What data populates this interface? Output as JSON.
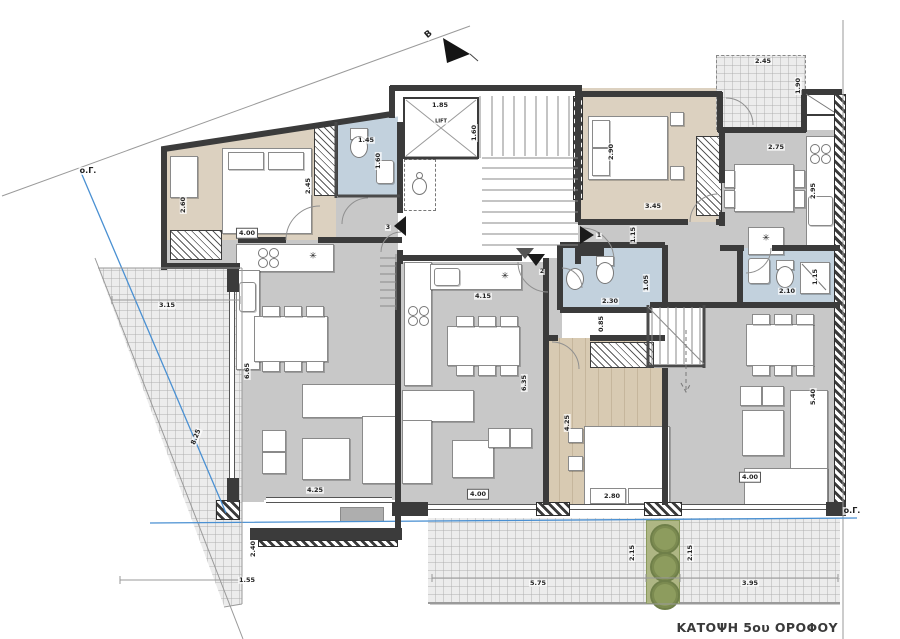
{
  "title": "ΚΑΤΟΨΗ 5ου ΟΡΟΦΟΥ",
  "colors": {
    "wall": "#3b3b3b",
    "floor_gray": "#c8c8c8",
    "floor_beige": "#dcd1c0",
    "floor_wood": "#d8cab2",
    "bath_blue": "#c2d1dd",
    "terrace": "#ececec",
    "planter_green": "#8d9c5e",
    "setback_blue": "#4a90d2"
  },
  "labels": [
    {
      "t": "ο.Γ.",
      "x": 88,
      "y": 171,
      "s": 8,
      "n": "boundary-label"
    },
    {
      "t": "ο.Γ.",
      "x": 852,
      "y": 511,
      "s": 8,
      "n": "boundary-label"
    },
    {
      "t": "B",
      "x": 429,
      "y": 35,
      "r": -40,
      "s": 9,
      "n": "north-label"
    },
    {
      "t": "1.85",
      "x": 440,
      "y": 105
    },
    {
      "t": "LIFT",
      "x": 441,
      "y": 122,
      "s": 5,
      "n": "lift-label"
    },
    {
      "t": "1.60",
      "x": 474,
      "y": 133,
      "r": -90
    },
    {
      "t": "1.45",
      "x": 366,
      "y": 140
    },
    {
      "t": "1.60",
      "x": 378,
      "y": 161,
      "r": -90
    },
    {
      "t": "2.45",
      "x": 308,
      "y": 186,
      "r": -90
    },
    {
      "t": "2.60",
      "x": 183,
      "y": 205,
      "r": -90
    },
    {
      "t": "4.00",
      "x": 247,
      "y": 233,
      "box": true
    },
    {
      "t": "3.15",
      "x": 167,
      "y": 305
    },
    {
      "t": "8.25",
      "x": 196,
      "y": 437,
      "r": -68
    },
    {
      "t": "6.65",
      "x": 247,
      "y": 371,
      "r": -90
    },
    {
      "t": "4.25",
      "x": 315,
      "y": 490
    },
    {
      "t": "2.40",
      "x": 253,
      "y": 549,
      "r": -90
    },
    {
      "t": "1.55",
      "x": 247,
      "y": 580
    },
    {
      "t": "4.15",
      "x": 483,
      "y": 296
    },
    {
      "t": "6.35",
      "x": 524,
      "y": 383,
      "r": -90
    },
    {
      "t": "4.00",
      "x": 478,
      "y": 494,
      "box": true
    },
    {
      "t": "4.25",
      "x": 567,
      "y": 423,
      "r": -90
    },
    {
      "t": "2.80",
      "x": 612,
      "y": 496
    },
    {
      "t": "2.30",
      "x": 610,
      "y": 301
    },
    {
      "t": "1.05",
      "x": 646,
      "y": 283,
      "r": -90
    },
    {
      "t": "0.85",
      "x": 601,
      "y": 324,
      "r": -90
    },
    {
      "t": "2.90",
      "x": 611,
      "y": 152,
      "r": -90
    },
    {
      "t": "3.45",
      "x": 653,
      "y": 206
    },
    {
      "t": "1.15",
      "x": 633,
      "y": 235,
      "r": -90
    },
    {
      "t": "2.45",
      "x": 763,
      "y": 61
    },
    {
      "t": "1.90",
      "x": 798,
      "y": 86,
      "r": -90
    },
    {
      "t": "2.75",
      "x": 776,
      "y": 147
    },
    {
      "t": "2.95",
      "x": 813,
      "y": 191,
      "r": -90
    },
    {
      "t": "2.10",
      "x": 787,
      "y": 291
    },
    {
      "t": "1.15",
      "x": 815,
      "y": 277,
      "r": -90
    },
    {
      "t": "5.40",
      "x": 813,
      "y": 397,
      "r": -90
    },
    {
      "t": "4.00",
      "x": 750,
      "y": 477,
      "box": true
    },
    {
      "t": "2.15",
      "x": 632,
      "y": 553,
      "r": -90
    },
    {
      "t": "2.15",
      "x": 690,
      "y": 553,
      "r": -90
    },
    {
      "t": "5.75",
      "x": 538,
      "y": 583
    },
    {
      "t": "3.95",
      "x": 750,
      "y": 583
    },
    {
      "t": "1",
      "x": 599,
      "y": 236,
      "s": 6,
      "n": "entrance-number"
    },
    {
      "t": "2",
      "x": 542,
      "y": 272,
      "s": 6,
      "n": "entrance-number"
    },
    {
      "t": "3",
      "x": 388,
      "y": 228,
      "s": 6,
      "n": "entrance-number"
    },
    {
      "t": "✳",
      "x": 313,
      "y": 257,
      "s": 9,
      "n": "appliance-icon"
    },
    {
      "t": "✳",
      "x": 505,
      "y": 277,
      "s": 9,
      "n": "appliance-icon"
    },
    {
      "t": "✳",
      "x": 766,
      "y": 239,
      "s": 9,
      "n": "appliance-icon"
    }
  ]
}
